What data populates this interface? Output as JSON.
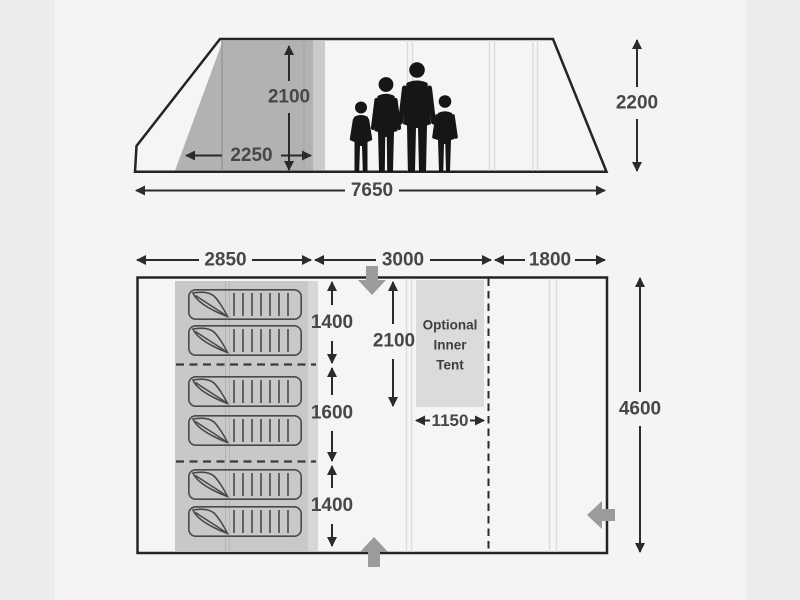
{
  "colors": {
    "page_background": "#edecec",
    "image_area": "#f5f4f3",
    "diagram_line": "#2b2b2b",
    "bedroom_shading": "#b3b2b1",
    "bedroom_shading_light": "#cccbca",
    "sleeping_panel": "#c9c8c7",
    "sleeping_panel_light": "#d8d7d6",
    "inner_tent_box": "#dcdbda",
    "entrance_arrow": "#9c9b9a",
    "silhouette": "#161616"
  },
  "side_view": {
    "dimensions": {
      "bedroom_height": "2100",
      "bedroom_width": "2250",
      "total_length": "7650",
      "max_height": "2200"
    }
  },
  "floor_plan": {
    "dimensions": {
      "front_section_width": "2850",
      "middle_section_width": "3000",
      "rear_section_width": "1800",
      "total_depth": "4600",
      "berth_top": "1400",
      "berth_middle": "1600",
      "berth_bottom": "1400",
      "living_height": "2100",
      "inner_tent_width": "1150"
    },
    "inner_tent_label": {
      "line1": "Optional",
      "line2": "Inner",
      "line3": "Tent"
    }
  }
}
